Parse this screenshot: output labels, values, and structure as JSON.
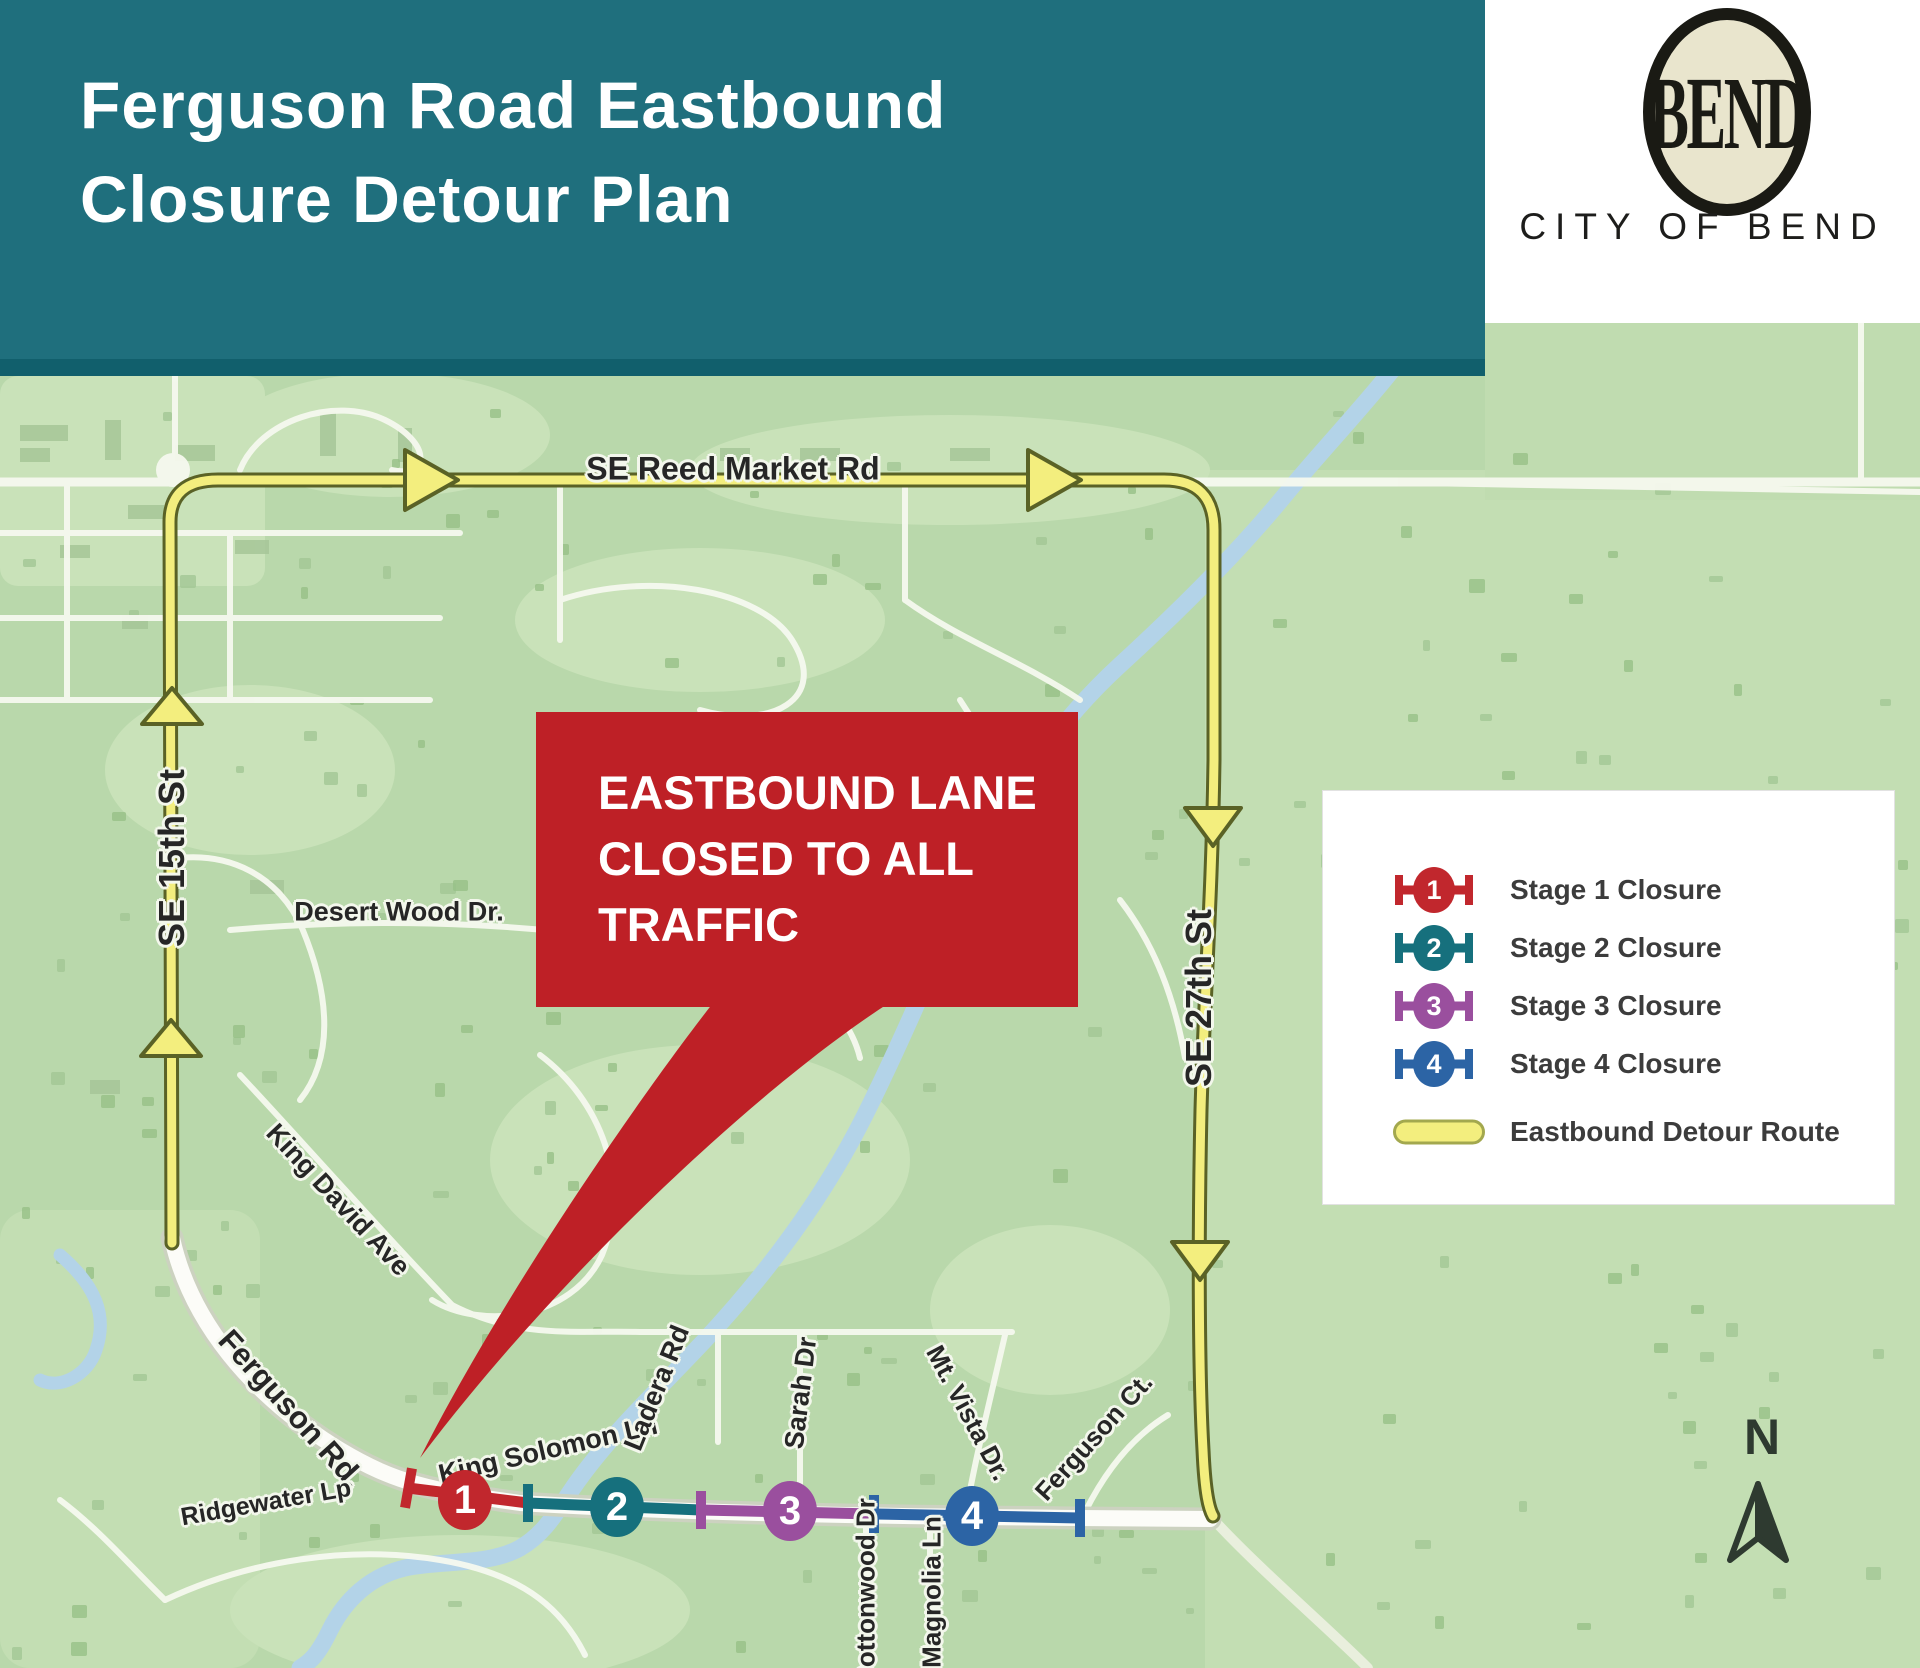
{
  "header": {
    "title_line1": "Ferguson Road Eastbound",
    "title_line2": "Closure Detour Plan",
    "bg": "#1f6f7d"
  },
  "logo": {
    "monogram": "BEND",
    "org": "CITY OF BEND"
  },
  "callout": {
    "line1": "EASTBOUND LANE",
    "line2": "CLOSED TO ALL",
    "line3": "TRAFFIC",
    "bg": "#be2026"
  },
  "legend": {
    "items": [
      {
        "num": "1",
        "label": "Stage 1 Closure",
        "color": "#c1272d"
      },
      {
        "num": "2",
        "label": "Stage 2 Closure",
        "color": "#16707d"
      },
      {
        "num": "3",
        "label": "Stage 3 Closure",
        "color": "#9a4f9e"
      },
      {
        "num": "4",
        "label": "Stage 4 Closure",
        "color": "#2c64a5"
      },
      {
        "label": "Eastbound Detour Route",
        "color": "#f3ee7e"
      }
    ]
  },
  "map": {
    "route_color": "#f3ee7e",
    "north_label": "N",
    "street_labels": [
      {
        "text": "SE Reed Market Rd"
      },
      {
        "text": "SE 15th St"
      },
      {
        "text": "SE 27th St"
      },
      {
        "text": "Desert Wood Dr."
      },
      {
        "text": "King David Ave"
      },
      {
        "text": "Ferguson Rd."
      },
      {
        "text": "Ridgewater Lp"
      },
      {
        "text": "King Solomon Ln"
      },
      {
        "text": "Ladera Rd"
      },
      {
        "text": "Sarah Dr"
      },
      {
        "text": "Mt. Vista Dr."
      },
      {
        "text": "Ferguson Ct."
      },
      {
        "text": "Cottonwood Dr"
      },
      {
        "text": "Magnolia Ln"
      }
    ]
  }
}
